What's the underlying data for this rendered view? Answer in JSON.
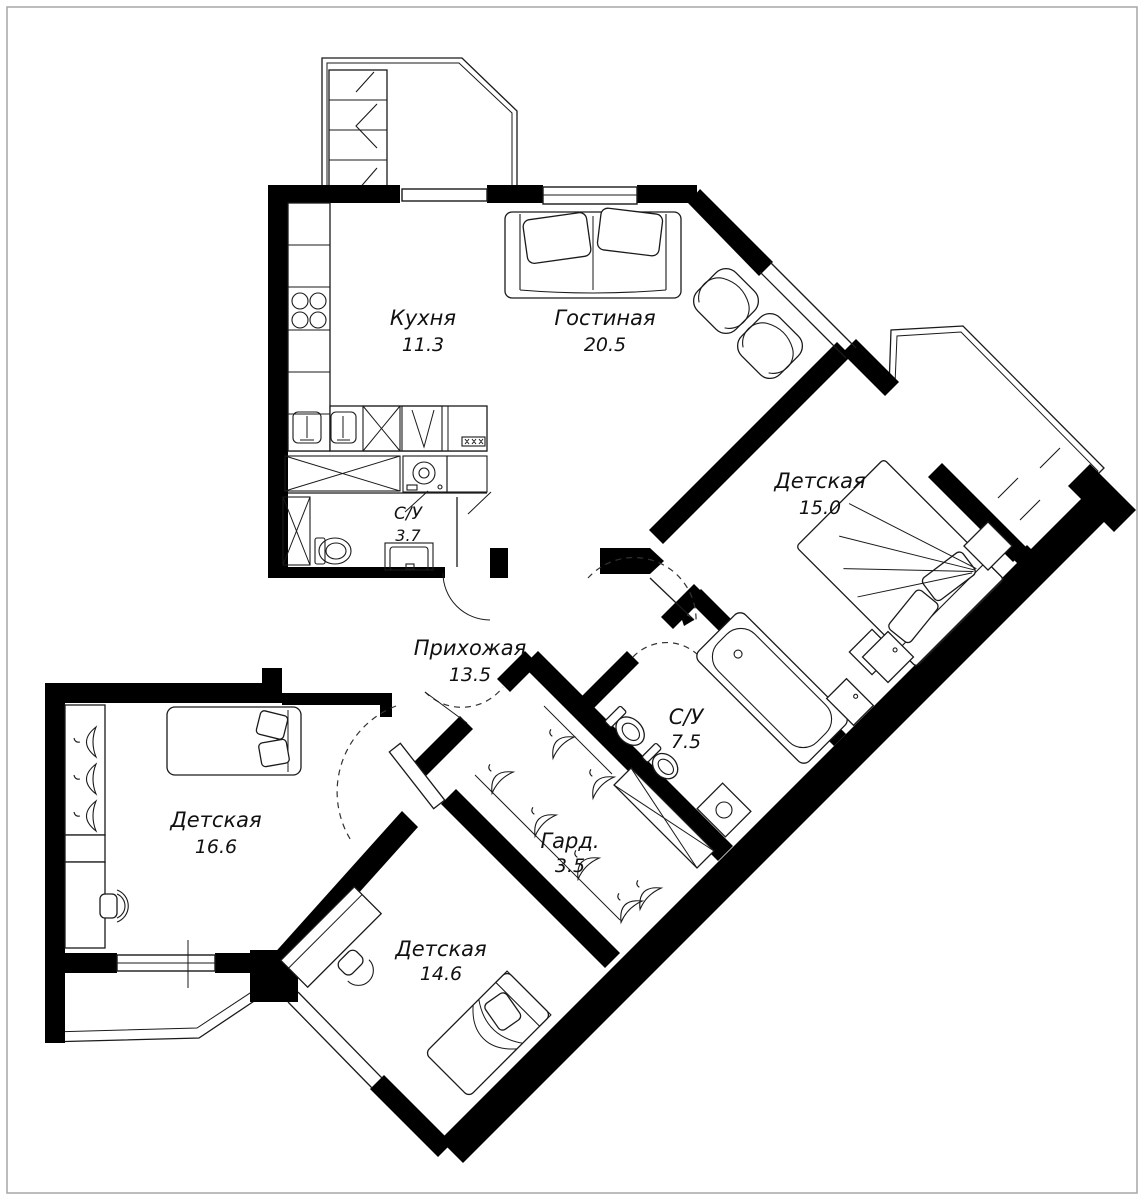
{
  "floorplan": {
    "rooms": [
      {
        "id": "kitchen",
        "name": "Кухня",
        "area": "11.3"
      },
      {
        "id": "living",
        "name": "Гостиная",
        "area": "20.5"
      },
      {
        "id": "child1",
        "name": "Детская",
        "area": "15.0"
      },
      {
        "id": "bath-small",
        "name": "С/У",
        "area": "3.7"
      },
      {
        "id": "hall",
        "name": "Прихожая",
        "area": "13.5"
      },
      {
        "id": "bath-big",
        "name": "С/У",
        "area": "7.5"
      },
      {
        "id": "child2",
        "name": "Детская",
        "area": "16.6"
      },
      {
        "id": "wardrobe",
        "name": "Гард.",
        "area": "3.5"
      },
      {
        "id": "child3",
        "name": "Детская",
        "area": "14.6"
      }
    ],
    "colors": {
      "wall": "#000000",
      "background": "#ffffff",
      "page_border": "#a6a6a6"
    }
  }
}
